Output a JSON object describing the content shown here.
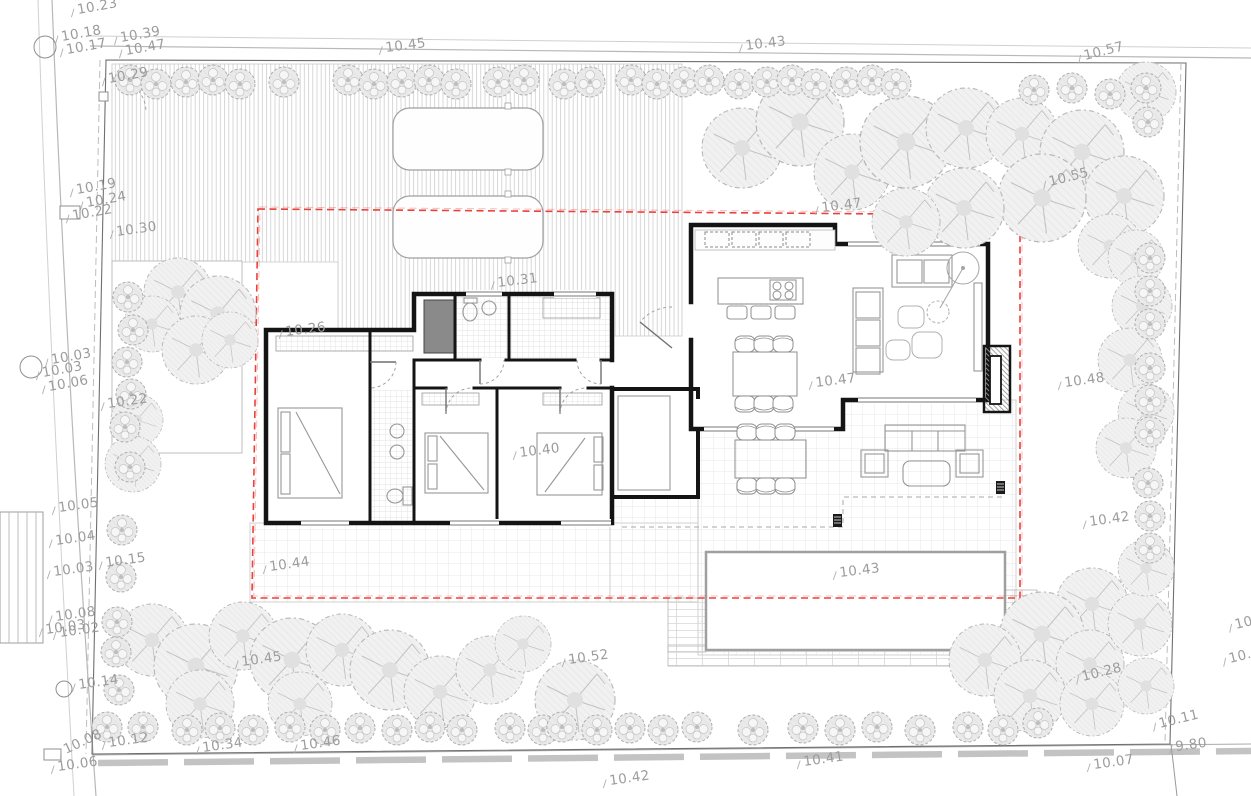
{
  "drawing": {
    "type": "architectural-site-plan",
    "units": "spot elevations in meters"
  },
  "colors": {
    "roof_outline": "#e8423c",
    "wall": "#141414",
    "label": "#9c9c9c",
    "grid_line": "#e0e0e0",
    "hatch_line": "#cdcdcd",
    "vegetation_stroke": "#b6b6b6",
    "pool_border": "#9f9f9f",
    "road_dash": "#b5b5b5"
  },
  "elevation_labels": [
    {
      "text": "10.23",
      "x": 78,
      "y": 14,
      "rot": -10
    },
    {
      "text": "10.18",
      "x": 62,
      "y": 41,
      "rot": -10
    },
    {
      "text": "10.17",
      "x": 67,
      "y": 54,
      "rot": -10
    },
    {
      "text": "10.39",
      "x": 121,
      "y": 42,
      "rot": -10
    },
    {
      "text": "10.47",
      "x": 126,
      "y": 55,
      "rot": -10
    },
    {
      "text": "10.29",
      "x": 109,
      "y": 83,
      "rot": -10
    },
    {
      "text": "10.45",
      "x": 386,
      "y": 52,
      "rot": -7
    },
    {
      "text": "10.43",
      "x": 746,
      "y": 50,
      "rot": -7
    },
    {
      "text": "10.57",
      "x": 1085,
      "y": 60,
      "rot": -14
    },
    {
      "text": "10.55",
      "x": 1050,
      "y": 186,
      "rot": -14
    },
    {
      "text": "10.19",
      "x": 77,
      "y": 194,
      "rot": -10
    },
    {
      "text": "10.24",
      "x": 87,
      "y": 207,
      "rot": -10
    },
    {
      "text": "10.22",
      "x": 73,
      "y": 220,
      "rot": -10
    },
    {
      "text": "10.30",
      "x": 117,
      "y": 236,
      "rot": -8
    },
    {
      "text": "10.03",
      "x": 52,
      "y": 364,
      "rot": -10
    },
    {
      "text": "10.03",
      "x": 43,
      "y": 377,
      "rot": -10
    },
    {
      "text": "10.06",
      "x": 49,
      "y": 391,
      "rot": -10
    },
    {
      "text": "10.22",
      "x": 108,
      "y": 408,
      "rot": -8
    },
    {
      "text": "10.05",
      "x": 59,
      "y": 512,
      "rot": -8
    },
    {
      "text": "10.04",
      "x": 56,
      "y": 545,
      "rot": -8
    },
    {
      "text": "10.03",
      "x": 54,
      "y": 576,
      "rot": -8
    },
    {
      "text": "10.15",
      "x": 106,
      "y": 567,
      "rot": -8
    },
    {
      "text": "10.08",
      "x": 56,
      "y": 621,
      "rot": -8
    },
    {
      "text": "10.03",
      "x": 46,
      "y": 634,
      "rot": -8
    },
    {
      "text": "10.02",
      "x": 60,
      "y": 637,
      "rot": -8
    },
    {
      "text": "10.14",
      "x": 79,
      "y": 689,
      "rot": -8
    },
    {
      "text": "10.45",
      "x": 242,
      "y": 666,
      "rot": -8
    },
    {
      "text": "10.12",
      "x": 109,
      "y": 747,
      "rot": -8
    },
    {
      "text": "10.08",
      "x": 66,
      "y": 754,
      "rot": -25
    },
    {
      "text": "10.06",
      "x": 58,
      "y": 771,
      "rot": -8
    },
    {
      "text": "10.34",
      "x": 203,
      "y": 752,
      "rot": -8
    },
    {
      "text": "10.46",
      "x": 301,
      "y": 750,
      "rot": -8
    },
    {
      "text": "10.52",
      "x": 569,
      "y": 664,
      "rot": -8
    },
    {
      "text": "10.42",
      "x": 610,
      "y": 785,
      "rot": -8
    },
    {
      "text": "10.41",
      "x": 804,
      "y": 766,
      "rot": -8
    },
    {
      "text": "10.07",
      "x": 1094,
      "y": 769,
      "rot": -8
    },
    {
      "text": "9.80",
      "x": 1176,
      "y": 751,
      "rot": -8
    },
    {
      "text": "10.11",
      "x": 1160,
      "y": 728,
      "rot": -14
    },
    {
      "text": "10.28",
      "x": 1083,
      "y": 681,
      "rot": -14
    },
    {
      "text": "10.26",
      "x": 286,
      "y": 336,
      "rot": -7
    },
    {
      "text": "10.31",
      "x": 498,
      "y": 287,
      "rot": -7
    },
    {
      "text": "10.40",
      "x": 520,
      "y": 457,
      "rot": -7
    },
    {
      "text": "10.47",
      "x": 822,
      "y": 212,
      "rot": -7
    },
    {
      "text": "10.47",
      "x": 816,
      "y": 387,
      "rot": -7
    },
    {
      "text": "10.44",
      "x": 270,
      "y": 571,
      "rot": -8
    },
    {
      "text": "10.43",
      "x": 840,
      "y": 577,
      "rot": -7
    },
    {
      "text": "10.48",
      "x": 1065,
      "y": 387,
      "rot": -8
    },
    {
      "text": "10.42",
      "x": 1090,
      "y": 526,
      "rot": -8
    },
    {
      "text": "10",
      "x": 1236,
      "y": 629,
      "rot": -14
    },
    {
      "text": "10.0",
      "x": 1230,
      "y": 663,
      "rot": -14
    }
  ],
  "vegetation": {
    "trees": [
      [
        742,
        148,
        40
      ],
      [
        800,
        122,
        44
      ],
      [
        852,
        172,
        38
      ],
      [
        906,
        142,
        46
      ],
      [
        966,
        128,
        40
      ],
      [
        1022,
        134,
        36
      ],
      [
        1082,
        152,
        42
      ],
      [
        1124,
        196,
        40
      ],
      [
        1042,
        198,
        44
      ],
      [
        964,
        208,
        40
      ],
      [
        906,
        222,
        34
      ],
      [
        1146,
        92,
        30
      ],
      [
        1110,
        246,
        32
      ],
      [
        1136,
        258,
        28
      ],
      [
        1142,
        306,
        30
      ],
      [
        1130,
        360,
        32
      ],
      [
        1146,
        412,
        28
      ],
      [
        1126,
        448,
        30
      ],
      [
        178,
        292,
        34
      ],
      [
        218,
        314,
        38
      ],
      [
        152,
        324,
        28
      ],
      [
        196,
        350,
        34
      ],
      [
        230,
        340,
        28
      ],
      [
        137,
        420,
        26
      ],
      [
        133,
        464,
        28
      ],
      [
        152,
        640,
        36
      ],
      [
        196,
        666,
        42
      ],
      [
        243,
        636,
        34
      ],
      [
        292,
        660,
        42
      ],
      [
        342,
        650,
        36
      ],
      [
        390,
        670,
        40
      ],
      [
        300,
        704,
        32
      ],
      [
        200,
        704,
        34
      ],
      [
        440,
        692,
        36
      ],
      [
        490,
        670,
        34
      ],
      [
        523,
        644,
        28
      ],
      [
        575,
        700,
        40
      ],
      [
        1092,
        604,
        36
      ],
      [
        1042,
        634,
        42
      ],
      [
        1090,
        664,
        34
      ],
      [
        1140,
        624,
        32
      ],
      [
        1146,
        568,
        28
      ],
      [
        985,
        660,
        36
      ],
      [
        1030,
        696,
        36
      ],
      [
        1092,
        704,
        32
      ],
      [
        1146,
        686,
        28
      ]
    ],
    "shrubs": [
      [
        130,
        80
      ],
      [
        156,
        84
      ],
      [
        186,
        82
      ],
      [
        213,
        80
      ],
      [
        240,
        84
      ],
      [
        284,
        82
      ],
      [
        348,
        80
      ],
      [
        374,
        84
      ],
      [
        402,
        82
      ],
      [
        429,
        80
      ],
      [
        456,
        84
      ],
      [
        498,
        82
      ],
      [
        524,
        80
      ],
      [
        564,
        84
      ],
      [
        590,
        82
      ],
      [
        631,
        80
      ],
      [
        657,
        84
      ],
      [
        684,
        82
      ],
      [
        709,
        80
      ],
      [
        739,
        84
      ],
      [
        767,
        82
      ],
      [
        792,
        80
      ],
      [
        816,
        84
      ],
      [
        846,
        82
      ],
      [
        872,
        80
      ],
      [
        896,
        84
      ],
      [
        1034,
        90
      ],
      [
        1072,
        88
      ],
      [
        1110,
        94
      ],
      [
        1146,
        88
      ],
      [
        1148,
        122
      ],
      [
        128,
        297
      ],
      [
        133,
        330
      ],
      [
        127,
        362
      ],
      [
        131,
        394
      ],
      [
        125,
        427
      ],
      [
        130,
        467
      ],
      [
        122,
        530
      ],
      [
        121,
        577
      ],
      [
        117,
        622
      ],
      [
        116,
        652
      ],
      [
        119,
        690
      ],
      [
        1150,
        258
      ],
      [
        1150,
        291
      ],
      [
        1150,
        324
      ],
      [
        1150,
        368
      ],
      [
        1150,
        400
      ],
      [
        1150,
        432
      ],
      [
        1148,
        483
      ],
      [
        1150,
        516
      ],
      [
        1150,
        548
      ],
      [
        107,
        727
      ],
      [
        143,
        727
      ],
      [
        187,
        730
      ],
      [
        220,
        728
      ],
      [
        253,
        730
      ],
      [
        290,
        727
      ],
      [
        325,
        730
      ],
      [
        360,
        728
      ],
      [
        397,
        730
      ],
      [
        430,
        727
      ],
      [
        462,
        730
      ],
      [
        510,
        728
      ],
      [
        543,
        730
      ],
      [
        562,
        727
      ],
      [
        597,
        730
      ],
      [
        630,
        728
      ],
      [
        663,
        730
      ],
      [
        697,
        727
      ],
      [
        753,
        730
      ],
      [
        803,
        728
      ],
      [
        840,
        730
      ],
      [
        877,
        727
      ],
      [
        920,
        730
      ],
      [
        968,
        727
      ],
      [
        1003,
        730
      ],
      [
        1038,
        723
      ]
    ]
  },
  "survey_markers": {
    "manholes": [
      [
        45,
        47,
        11
      ],
      [
        31,
        367,
        11
      ],
      [
        64,
        689,
        8
      ]
    ],
    "utility_boxes": [
      [
        60,
        206,
        20,
        13
      ],
      [
        44,
        749,
        17,
        11
      ],
      [
        99,
        92,
        9,
        9
      ]
    ]
  }
}
